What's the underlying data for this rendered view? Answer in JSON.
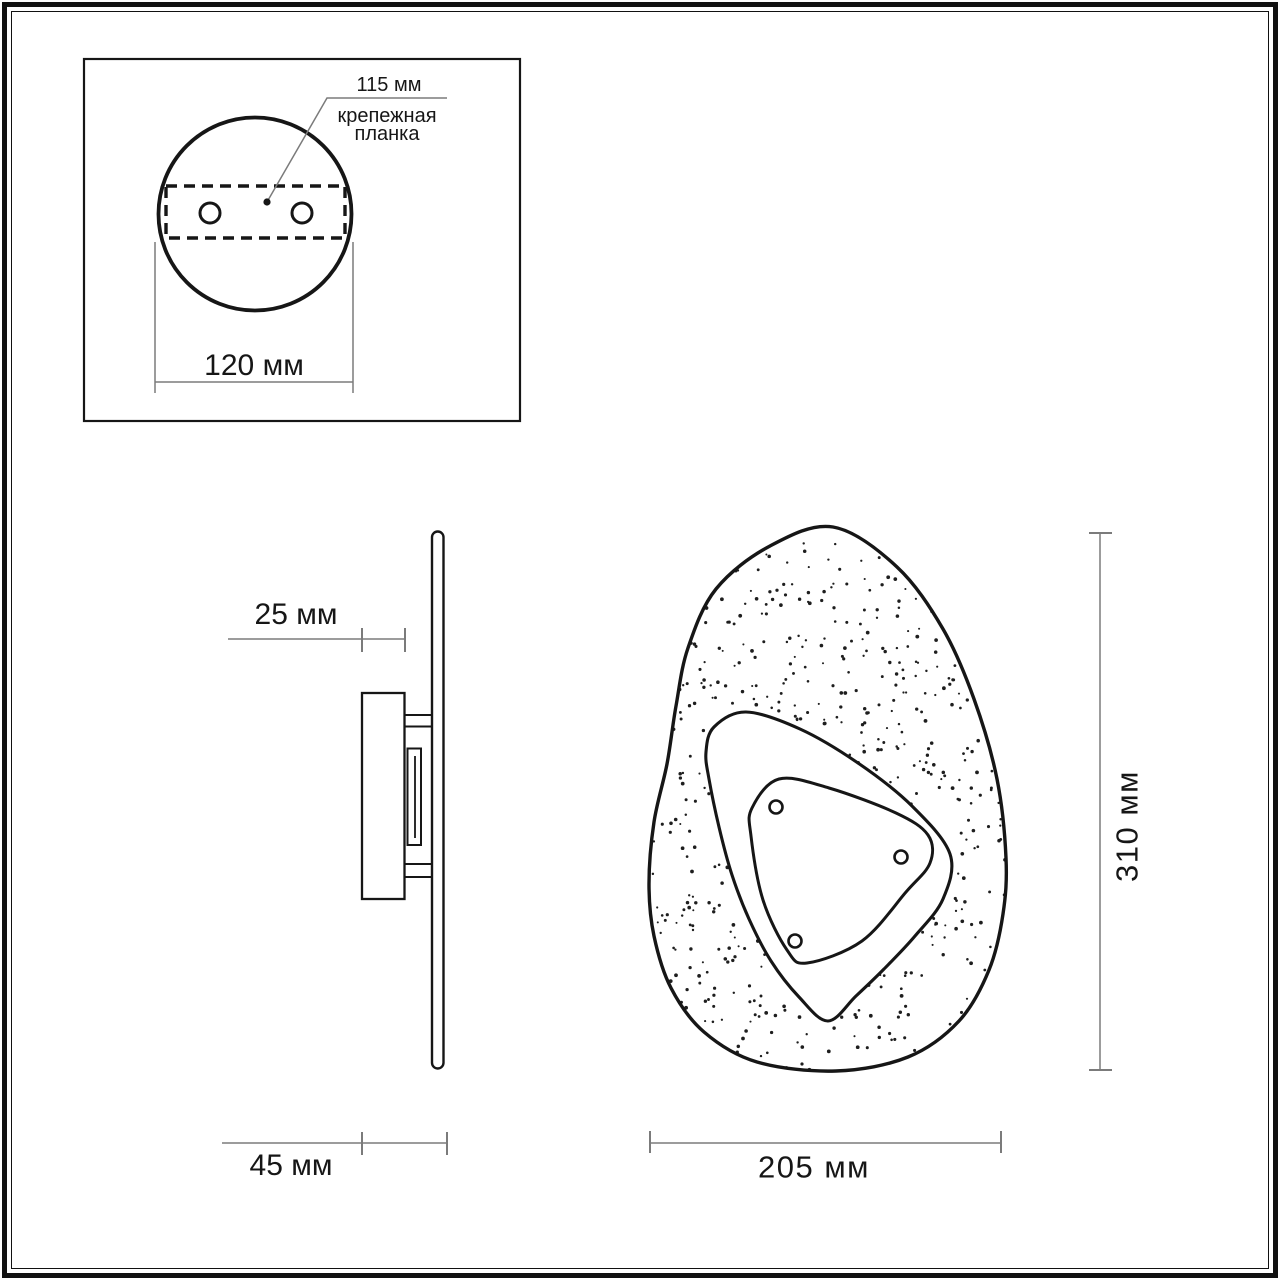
{
  "title": "wall-lamp-dimension-drawing",
  "inset": {
    "dim_width": "120 мм",
    "anchor_value": "115 мм",
    "anchor_label_line1": "крепежная",
    "anchor_label_line2": "планка"
  },
  "side_view": {
    "dim_depth_plate": "25 мм",
    "dim_depth_total": "45 мм"
  },
  "front_view": {
    "dim_width": "205 мм",
    "dim_height": "310 мм"
  },
  "colors": {
    "background": "#ffffff",
    "outline": "#161616",
    "dimension_line": "#7b7b7b",
    "text": "#161616",
    "stipple_dot": "#1e1e1e"
  }
}
